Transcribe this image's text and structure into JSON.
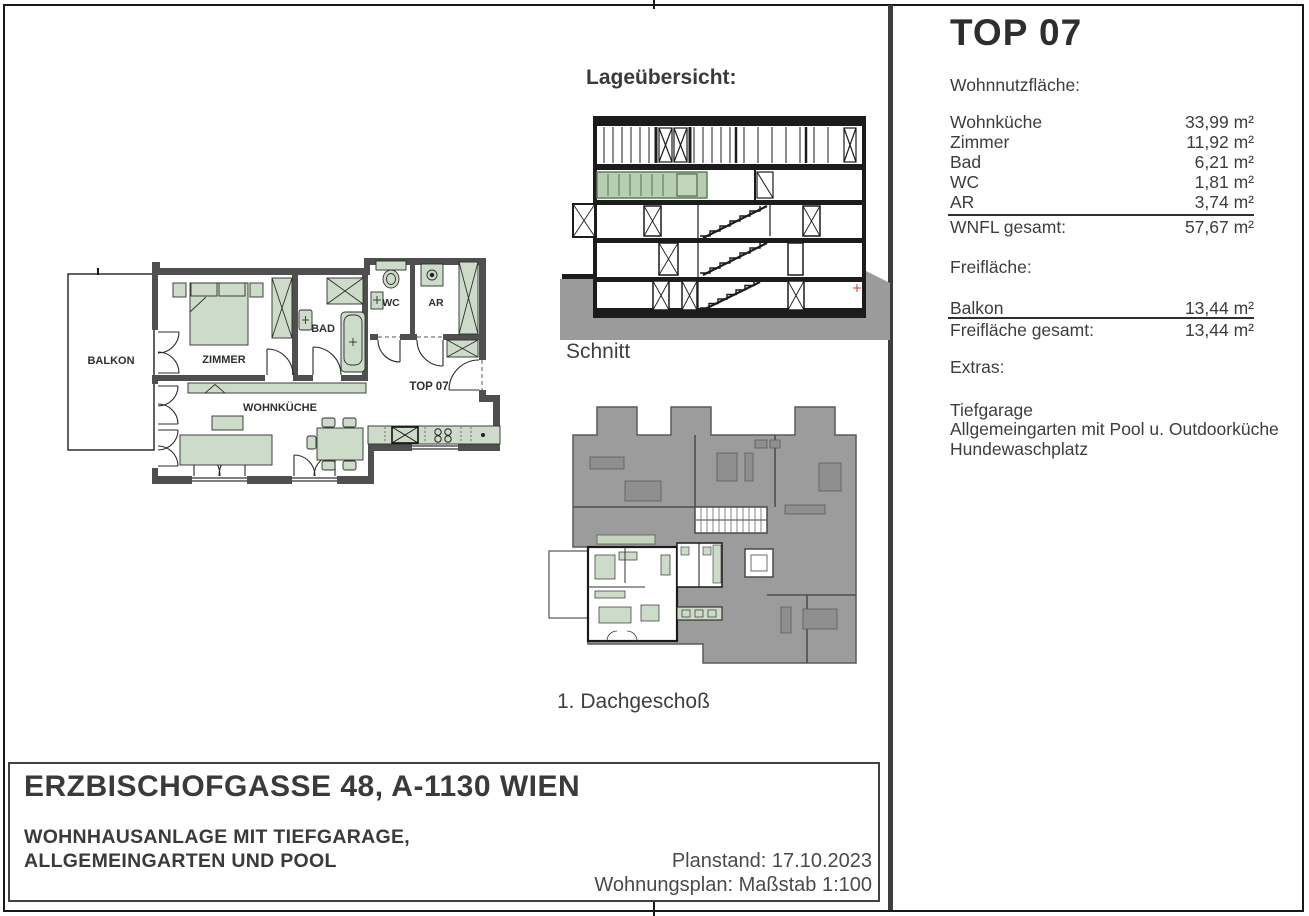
{
  "overview": {
    "heading": "Lageübersicht:",
    "section_label": "Schnitt",
    "floor_label": "1. Dachgeschoß"
  },
  "floor_plan": {
    "labels": {
      "balkon": "BALKON",
      "zimmer": "ZIMMER",
      "bad": "BAD",
      "wc": "WC",
      "ar": "AR",
      "wohnkueche": "WOHNKÜCHE",
      "top": "TOP 07"
    }
  },
  "info_panel": {
    "title": "TOP 07",
    "living_area": {
      "heading": "Wohnnutzfläche:",
      "rows": [
        {
          "label": "Wohnküche",
          "value": "33,99 m²"
        },
        {
          "label": "Zimmer",
          "value": "11,92 m²"
        },
        {
          "label": "Bad",
          "value": "6,21 m²"
        },
        {
          "label": "WC",
          "value": "1,81 m²"
        },
        {
          "label": "AR",
          "value": "3,74 m²"
        }
      ],
      "total_label": "WNFL gesamt:",
      "total_value": "57,67 m²"
    },
    "free_area": {
      "heading": "Freifläche:",
      "rows": [
        {
          "label": "Balkon",
          "value": "13,44 m²"
        }
      ],
      "total_label": "Freifläche gesamt:",
      "total_value": "13,44 m²"
    },
    "extras": {
      "heading": "Extras:",
      "items": [
        "Tiefgarage",
        "Allgemeingarten mit Pool u. Outdoorküche",
        "Hundewaschplatz"
      ]
    }
  },
  "title_block": {
    "address": "ERZBISCHOFGASSE 48, A-1130 WIEN",
    "subtitle_line1": "WOHNHAUSANLAGE MIT TIEFGARAGE,",
    "subtitle_line2": "ALLGEMEINGARTEN UND POOL",
    "plan_status": "Planstand: 17.10.2023",
    "plan_type": "Wohnungsplan: Maßstab 1:100"
  },
  "colors": {
    "furniture_green": "#cddcc9",
    "highlight_green": "#b7ceb3",
    "wall_gray": "#4f4f4f",
    "ground_gray": "#9b9b9b",
    "building_mass_gray": "#9c9c9c",
    "text_dark": "#3d3d3d"
  }
}
